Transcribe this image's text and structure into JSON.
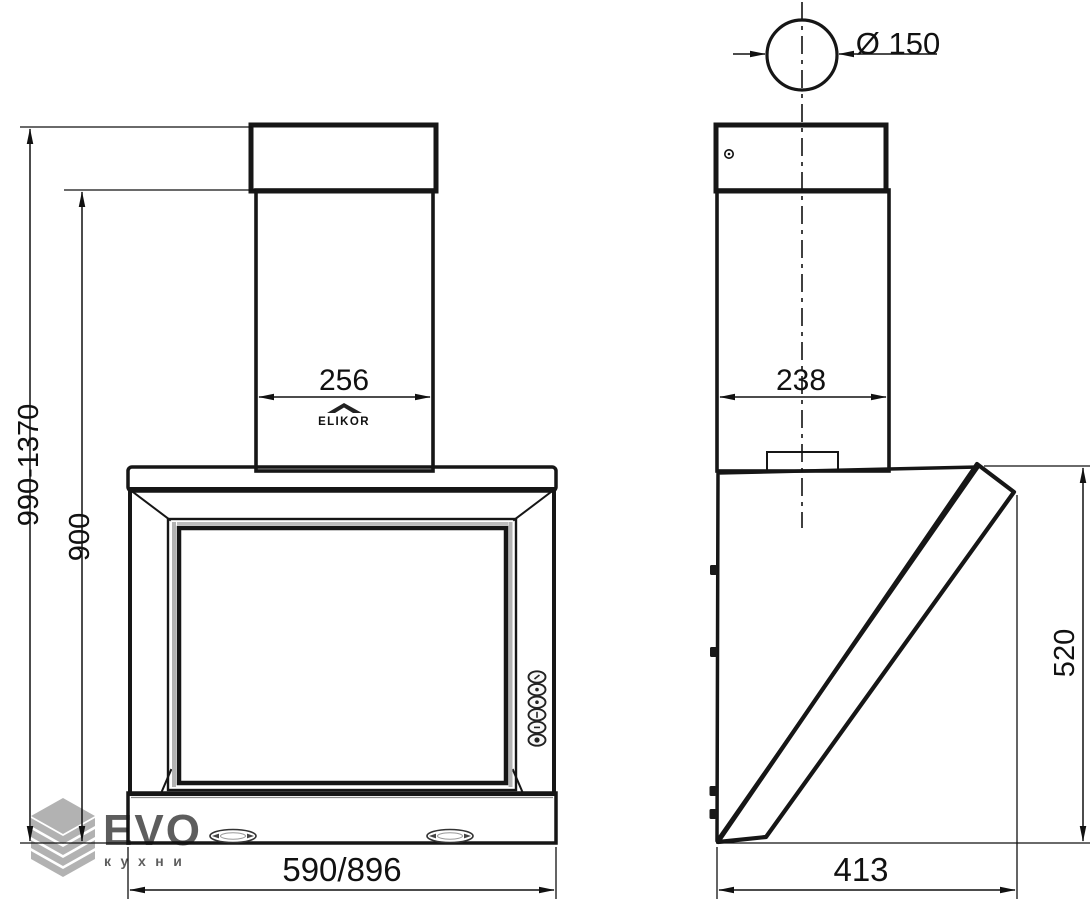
{
  "brand_label": "ELIKOR",
  "dimensions": {
    "front": {
      "overall_height_range": "990-1370",
      "body_height": "900",
      "chimney_width": "256",
      "width_options": "590/896"
    },
    "side": {
      "duct_diameter": "Ø 150",
      "chimney_depth": "238",
      "inclined_panel_height": "520",
      "depth": "413"
    }
  },
  "watermark": {
    "brand": "EVO",
    "tagline": "кухни"
  },
  "colors": {
    "line": "#161616",
    "dimension_text": "#111111",
    "watermark_gray": "#8f8f8f",
    "background": "#ffffff",
    "fill_light_gray": "#ececec",
    "fill_dark_gray": "#bdbdbd"
  }
}
